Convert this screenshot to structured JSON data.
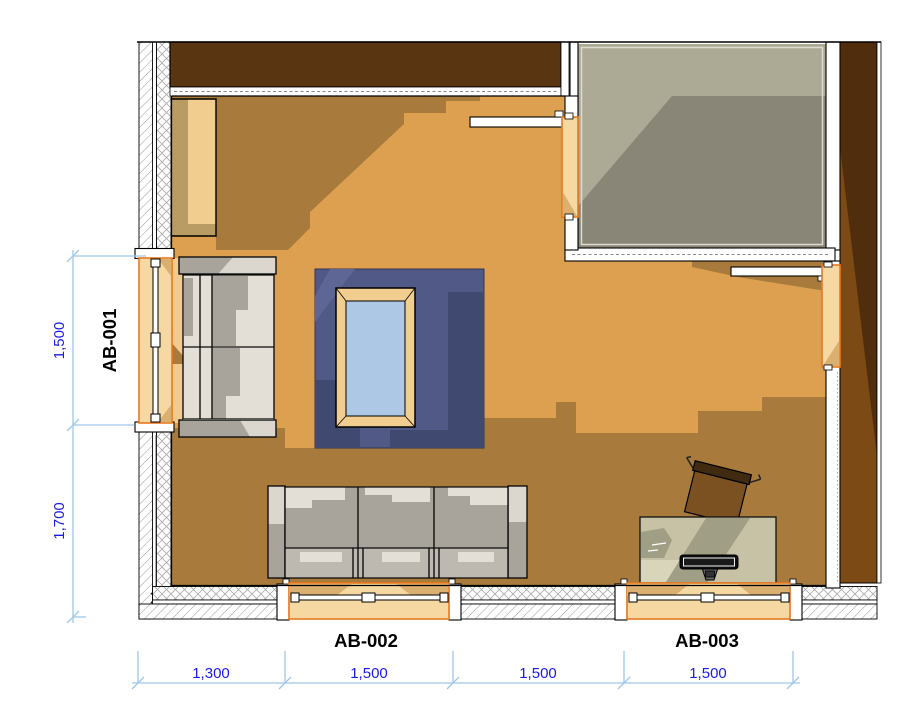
{
  "openings": {
    "left": "AB-001",
    "bottom_left": "AB-002",
    "bottom_right": "AB-003"
  },
  "dimensions": {
    "left": [
      {
        "value": "1,500"
      },
      {
        "value": "1,700"
      }
    ],
    "bottom": [
      {
        "value": "1,300"
      },
      {
        "value": "1,500"
      },
      {
        "value": "1,500"
      },
      {
        "value": "1,500"
      }
    ]
  },
  "colors": {
    "floor_base": "#DCA050",
    "floor_shadow": "#A87A3C",
    "floor_light": "#F0CA8E",
    "window_light": "#F6D9A2",
    "window_frame_accent": "#E8791D",
    "rug_base": "#515A86",
    "rug_shadow": "#40496F",
    "table_wood": "#F2CD90",
    "table_glass": "#ADC8E4",
    "sofa_light": "#DCD7CE",
    "sofa_shadow": "#A8A39B",
    "desk_top": "#C7C2A5",
    "chair_seat": "#7B5122",
    "side_room_floor": "#898677",
    "dark_wall_brown": "#5A3512",
    "dimension_line": "#9FC7EA",
    "dimension_text": "#1B1BE3",
    "label_text": "#000000"
  }
}
